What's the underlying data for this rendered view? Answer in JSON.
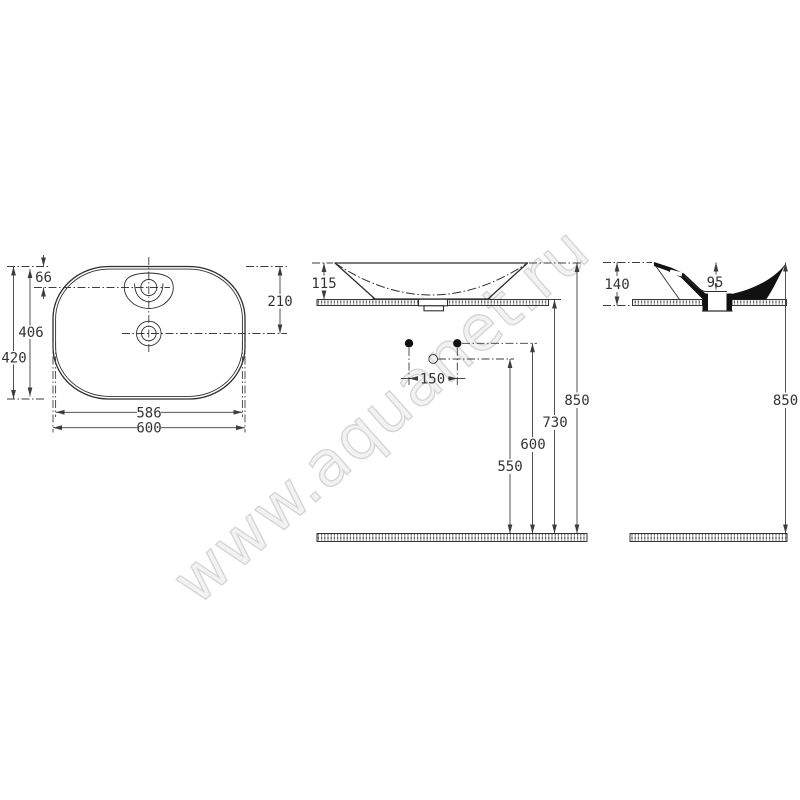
{
  "watermark": {
    "text": "www.aquanet.ru"
  },
  "colors": {
    "line": "#2e2e2e",
    "dimension": "#3d3d3d",
    "section_fill": "#111111",
    "watermark_fill": "#f2f2f2",
    "watermark_stroke": "#d4d4d4",
    "background": "#ffffff"
  },
  "views": {
    "top": {
      "label": "plan view",
      "dims": {
        "faucet_center_offset": "66",
        "inner_length": "406",
        "outer_length": "420",
        "drain_center_offset": "210",
        "inner_width": "586",
        "outer_width": "600"
      }
    },
    "front": {
      "label": "front view",
      "dims": {
        "basin_height": "115",
        "fixing_hole_spacing": "150",
        "trap_inlet_height": "550",
        "fixing_holes_height": "600",
        "countertop_height": "730",
        "rim_height": "850"
      }
    },
    "side": {
      "label": "side section view",
      "dims": {
        "overall_height": "140",
        "inner_depth": "95",
        "rim_height": "850"
      }
    }
  }
}
